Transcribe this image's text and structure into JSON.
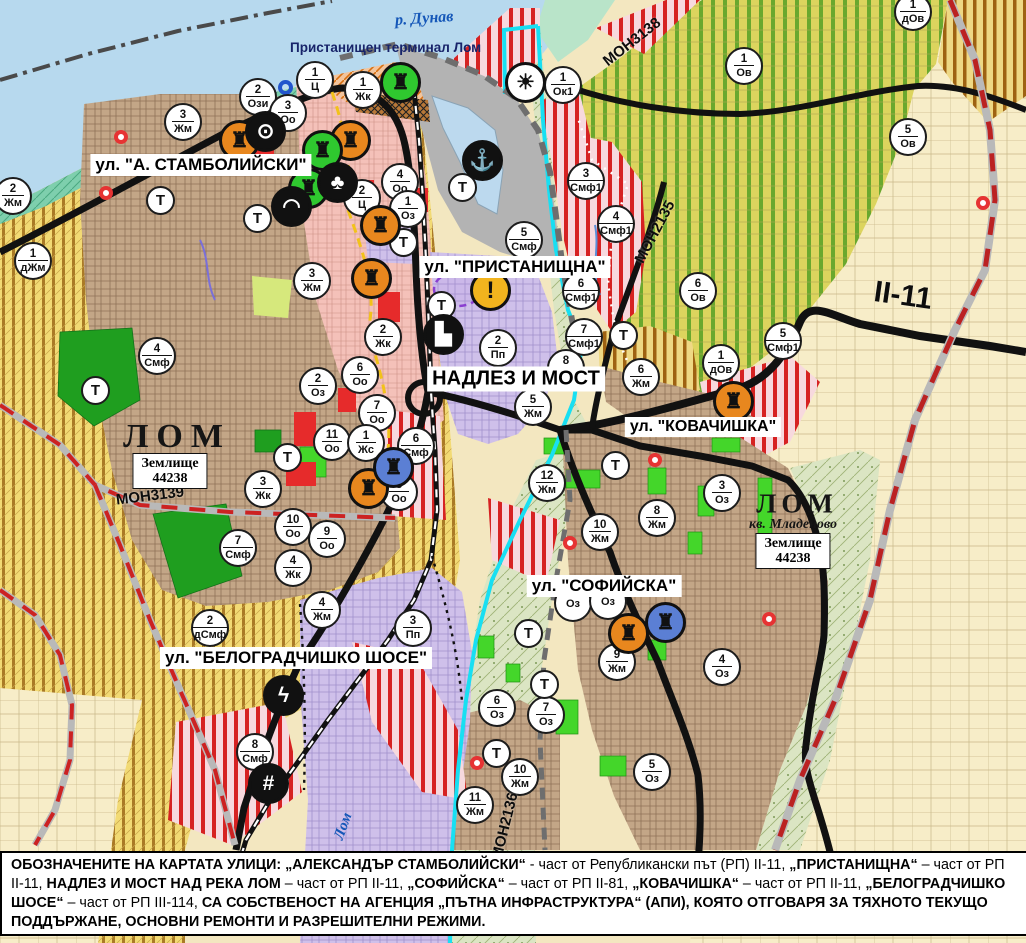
{
  "water_labels": {
    "danube": "р. Дунав",
    "lom_river": "Лом",
    "port": "Пристанищен терминал Лом"
  },
  "city_labels": [
    {
      "text": "ЛОМ",
      "x": 177,
      "y": 437,
      "size": 34,
      "ls": 8
    },
    {
      "text": "ЛОМ",
      "x": 797,
      "y": 504,
      "size": 27,
      "ls": 5
    }
  ],
  "district_label": {
    "text": "кв. Младеново",
    "x": 793,
    "y": 525
  },
  "land_boxes": [
    {
      "line1": "Землище",
      "line2": "44238",
      "x": 170,
      "y": 471
    },
    {
      "line1": "Землище",
      "line2": "44238",
      "x": 793,
      "y": 551
    }
  ],
  "street_labels": [
    {
      "text": "ул. \"А. СТАМБОЛИЙСКИ\"",
      "x": 201,
      "y": 165,
      "size": 17
    },
    {
      "text": "ул. \"ПРИСТАНИЩНА\"",
      "x": 515,
      "y": 267,
      "size": 17
    },
    {
      "text": "НАДЛЕЗ И МОСТ",
      "x": 516,
      "y": 379,
      "size": 20
    },
    {
      "text": "ул. \"КОВАЧИШКА\"",
      "x": 703,
      "y": 427,
      "size": 16
    },
    {
      "text": "ул. \"СОФИЙСКА\"",
      "x": 604,
      "y": 586,
      "size": 17
    },
    {
      "text": "ул. \"БЕЛОГРАДЧИШКО ШОСЕ\"",
      "x": 296,
      "y": 658,
      "size": 17
    }
  ],
  "road_labels": [
    {
      "text": "МОН3138",
      "x": 632,
      "y": 42,
      "rot": -38,
      "size": 15
    },
    {
      "text": "МОН2135",
      "x": 655,
      "y": 232,
      "rot": -62,
      "size": 15
    },
    {
      "text": "МОН3139",
      "x": 150,
      "y": 496,
      "rot": -7,
      "size": 15
    },
    {
      "text": "МОН2136",
      "x": 505,
      "y": 826,
      "rot": -76,
      "size": 15
    },
    {
      "text": "II-11",
      "x": 903,
      "y": 296,
      "rot": 8,
      "size": 30
    }
  ],
  "zone_markers": [
    [
      "2",
      "Ози",
      258,
      97
    ],
    [
      "1",
      "Ц",
      315,
      80
    ],
    [
      "3",
      "Оо",
      288,
      113
    ],
    [
      "1",
      "Жк",
      363,
      90
    ],
    [
      "3",
      "Жм",
      183,
      122
    ],
    [
      "2",
      "Жм",
      13,
      196
    ],
    [
      "1",
      "дЖм",
      33,
      261
    ],
    [
      "4",
      "Смф",
      157,
      356
    ],
    [
      "1",
      "Ок1",
      563,
      85
    ],
    [
      "3",
      "Смф1",
      586,
      181
    ],
    [
      "5",
      "Смф",
      524,
      240
    ],
    [
      "4",
      "Оо",
      400,
      182
    ],
    [
      "2",
      "Ц",
      362,
      198
    ],
    [
      "1",
      "Оз",
      408,
      209
    ],
    [
      "4",
      "Смф1",
      616,
      224
    ],
    [
      "6",
      "Смф1",
      581,
      291
    ],
    [
      "7",
      "Смф1",
      584,
      337
    ],
    [
      "5",
      "Смф1",
      783,
      341
    ],
    [
      "1",
      "дОв",
      721,
      363
    ],
    [
      "1",
      "Ов",
      744,
      66
    ],
    [
      "5",
      "Ов",
      908,
      137
    ],
    [
      "1",
      "дОв",
      913,
      12
    ],
    [
      "6",
      "Ов",
      698,
      291
    ],
    [
      "2",
      "Пп",
      498,
      348
    ],
    [
      "5",
      "Жм",
      533,
      407
    ],
    [
      "8",
      "Жм",
      566,
      368
    ],
    [
      "6",
      "Жм",
      641,
      377
    ],
    [
      "3",
      "Жм",
      312,
      281
    ],
    [
      "2",
      "Жк",
      383,
      337
    ],
    [
      "2",
      "Оз",
      318,
      386
    ],
    [
      "6",
      "Оо",
      360,
      375
    ],
    [
      "7",
      "Оо",
      377,
      413
    ],
    [
      "11",
      "Оо",
      332,
      442
    ],
    [
      "1",
      "Жс",
      366,
      443
    ],
    [
      "6",
      "Смф",
      416,
      446
    ],
    [
      "8",
      "Оо",
      399,
      492
    ],
    [
      "3",
      "Жк",
      263,
      489
    ],
    [
      "10",
      "Оо",
      293,
      527
    ],
    [
      "9",
      "Оо",
      327,
      539
    ],
    [
      "4",
      "Жк",
      293,
      568
    ],
    [
      "7",
      "Смф",
      238,
      548
    ],
    [
      "4",
      "Жм",
      322,
      610
    ],
    [
      "2",
      "дСмф",
      210,
      628
    ],
    [
      "3",
      "Пп",
      413,
      628
    ],
    [
      "8",
      "Смф",
      255,
      752
    ],
    [
      "12",
      "Жм",
      547,
      483
    ],
    [
      "10",
      "Жм",
      600,
      532
    ],
    [
      "8",
      "Жм",
      657,
      518
    ],
    [
      "3",
      "Оз",
      722,
      493
    ],
    [
      "9",
      "Жм",
      617,
      662
    ],
    [
      "4",
      "Оз",
      722,
      667
    ],
    [
      "",
      "Оз",
      573,
      603
    ],
    [
      "",
      "Оз",
      608,
      601
    ],
    [
      "6",
      "Оз",
      497,
      708
    ],
    [
      "7",
      "Оз",
      546,
      715
    ],
    [
      "10",
      "Жм",
      520,
      777
    ],
    [
      "11",
      "Жм",
      475,
      805
    ],
    [
      "5",
      "Оз",
      652,
      772
    ]
  ],
  "t_label": "Т",
  "t_markers": [
    [
      160,
      200
    ],
    [
      257,
      218
    ],
    [
      403,
      242
    ],
    [
      462,
      187
    ],
    [
      441,
      305
    ],
    [
      95,
      390
    ],
    [
      287,
      457
    ],
    [
      623,
      335
    ],
    [
      615,
      465
    ],
    [
      528,
      633
    ],
    [
      544,
      684
    ],
    [
      496,
      753
    ]
  ],
  "icon_markers": [
    {
      "name": "culture-monument-icon",
      "glyph": "♜",
      "bg": "#e8871e",
      "fg": "#111",
      "x": 239,
      "y": 140
    },
    {
      "name": "culture-monument-icon",
      "glyph": "♜",
      "bg": "#e8871e",
      "fg": "#111",
      "x": 350,
      "y": 140
    },
    {
      "name": "culture-monument-icon",
      "glyph": "♜",
      "bg": "#e8871e",
      "fg": "#111",
      "x": 380,
      "y": 225
    },
    {
      "name": "culture-monument-icon",
      "glyph": "♜",
      "bg": "#e8871e",
      "fg": "#111",
      "x": 371,
      "y": 278
    },
    {
      "name": "culture-monument-icon",
      "glyph": "♜",
      "bg": "#e8871e",
      "fg": "#111",
      "x": 368,
      "y": 488
    },
    {
      "name": "culture-monument-icon",
      "glyph": "♜",
      "bg": "#e8871e",
      "fg": "#111",
      "x": 628,
      "y": 633
    },
    {
      "name": "culture-monument-icon",
      "glyph": "♜",
      "bg": "#e8871e",
      "fg": "#111",
      "x": 733,
      "y": 401
    },
    {
      "name": "culture-monument-green-icon",
      "glyph": "♜",
      "bg": "#2fc82f",
      "fg": "#111",
      "x": 400,
      "y": 82
    },
    {
      "name": "culture-monument-green-icon",
      "glyph": "♜",
      "bg": "#2fc82f",
      "fg": "#111",
      "x": 322,
      "y": 150
    },
    {
      "name": "culture-monument-green-icon",
      "glyph": "♜",
      "bg": "#2fc82f",
      "fg": "#111",
      "x": 308,
      "y": 188
    },
    {
      "name": "culture-monument-blue-icon",
      "glyph": "♜",
      "bg": "#5b7fd4",
      "fg": "#111",
      "x": 393,
      "y": 467
    },
    {
      "name": "culture-monument-blue-icon",
      "glyph": "♜",
      "bg": "#5b7fd4",
      "fg": "#111",
      "x": 665,
      "y": 622
    },
    {
      "name": "power-station-icon",
      "glyph": "⊙",
      "bg": "#111",
      "fg": "#fff",
      "x": 265,
      "y": 131
    },
    {
      "name": "monument-club-icon",
      "glyph": "♣",
      "bg": "#111",
      "fg": "#fff",
      "x": 337,
      "y": 182
    },
    {
      "name": "tunnel-icon",
      "glyph": "◠",
      "bg": "#111",
      "fg": "#fff",
      "x": 291,
      "y": 206
    },
    {
      "name": "anchor-port-icon",
      "glyph": "⚓",
      "bg": "#111",
      "fg": "#fff",
      "x": 482,
      "y": 160
    },
    {
      "name": "truck-terminal-icon",
      "glyph": "▙",
      "bg": "#111",
      "fg": "#fff",
      "x": 443,
      "y": 334
    },
    {
      "name": "railway-crossing-icon",
      "glyph": "#",
      "bg": "#111",
      "fg": "#fff",
      "x": 268,
      "y": 783
    },
    {
      "name": "lightning-substation-icon",
      "glyph": "ϟ",
      "bg": "#111",
      "fg": "#fff",
      "x": 283,
      "y": 695
    },
    {
      "name": "crane-icon",
      "glyph": "☀",
      "bg": "#fff",
      "fg": "#111",
      "x": 525,
      "y": 82
    },
    {
      "name": "warning-icon",
      "glyph": "!",
      "bg": "#f2b41e",
      "fg": "#111",
      "x": 490,
      "y": 290
    }
  ],
  "dots": {
    "red": [
      [
        121,
        137
      ],
      [
        106,
        193
      ],
      [
        655,
        460
      ],
      [
        570,
        543
      ],
      [
        477,
        763
      ],
      [
        769,
        619
      ],
      [
        983,
        203
      ]
    ],
    "blue": [
      [
        285,
        87
      ]
    ]
  },
  "footer": {
    "segments": [
      {
        "t": "ОБОЗНАЧЕНИТЕ НА КАРТАТА УЛИЦИ: „АЛЕКСАНДЪР СТАМБОЛИЙСКИ“",
        "b": true
      },
      {
        "t": " - част от Републикански път (РП) II-11, ",
        "b": false
      },
      {
        "t": "„ПРИСТАНИЩНА“",
        "b": true
      },
      {
        "t": " – част от РП II-11, ",
        "b": false
      },
      {
        "t": "НАДЛЕЗ И МОСТ НАД РЕКА ЛОМ",
        "b": true
      },
      {
        "t": " – част от РП II-11, ",
        "b": false
      },
      {
        "t": "„СОФИЙСКА“",
        "b": true
      },
      {
        "t": " – част от РП II-81, ",
        "b": false
      },
      {
        "t": "„КОВАЧИШКА“",
        "b": true
      },
      {
        "t": " – част от РП II-11, ",
        "b": false
      },
      {
        "t": "„БЕЛОГРАДЧИШКО ШОСЕ“",
        "b": true
      },
      {
        "t": " – част от РП III-114, ",
        "b": false
      },
      {
        "t": "СА СОБСТВЕНОСТ НА АГЕНЦИЯ „ПЪТНА ИНФРАСТРУКТУРА“ (АПИ), КОЯТО ОТГОВАРЯ ЗА ТЯХНОТО ТЕКУЩО ПОДДЪРЖАНЕ, ОСНОВНИ РЕМОНТИ И РАЗРЕШИТЕЛНИ РЕЖИМИ.",
        "b": true
      }
    ]
  },
  "colors": {
    "water": "#b7d9ee",
    "residential_brown": "#c3a687",
    "villa_yellow": "#f2da74",
    "vineyard_green": "#dcd45e",
    "mixed_red_stripe": "#d62222",
    "industry_lavender": "#cfc0ea",
    "park_green": "#3ec22a",
    "road_black": "#111111",
    "boundary_red": "#cc2222",
    "river_cyan": "#18dff2"
  }
}
